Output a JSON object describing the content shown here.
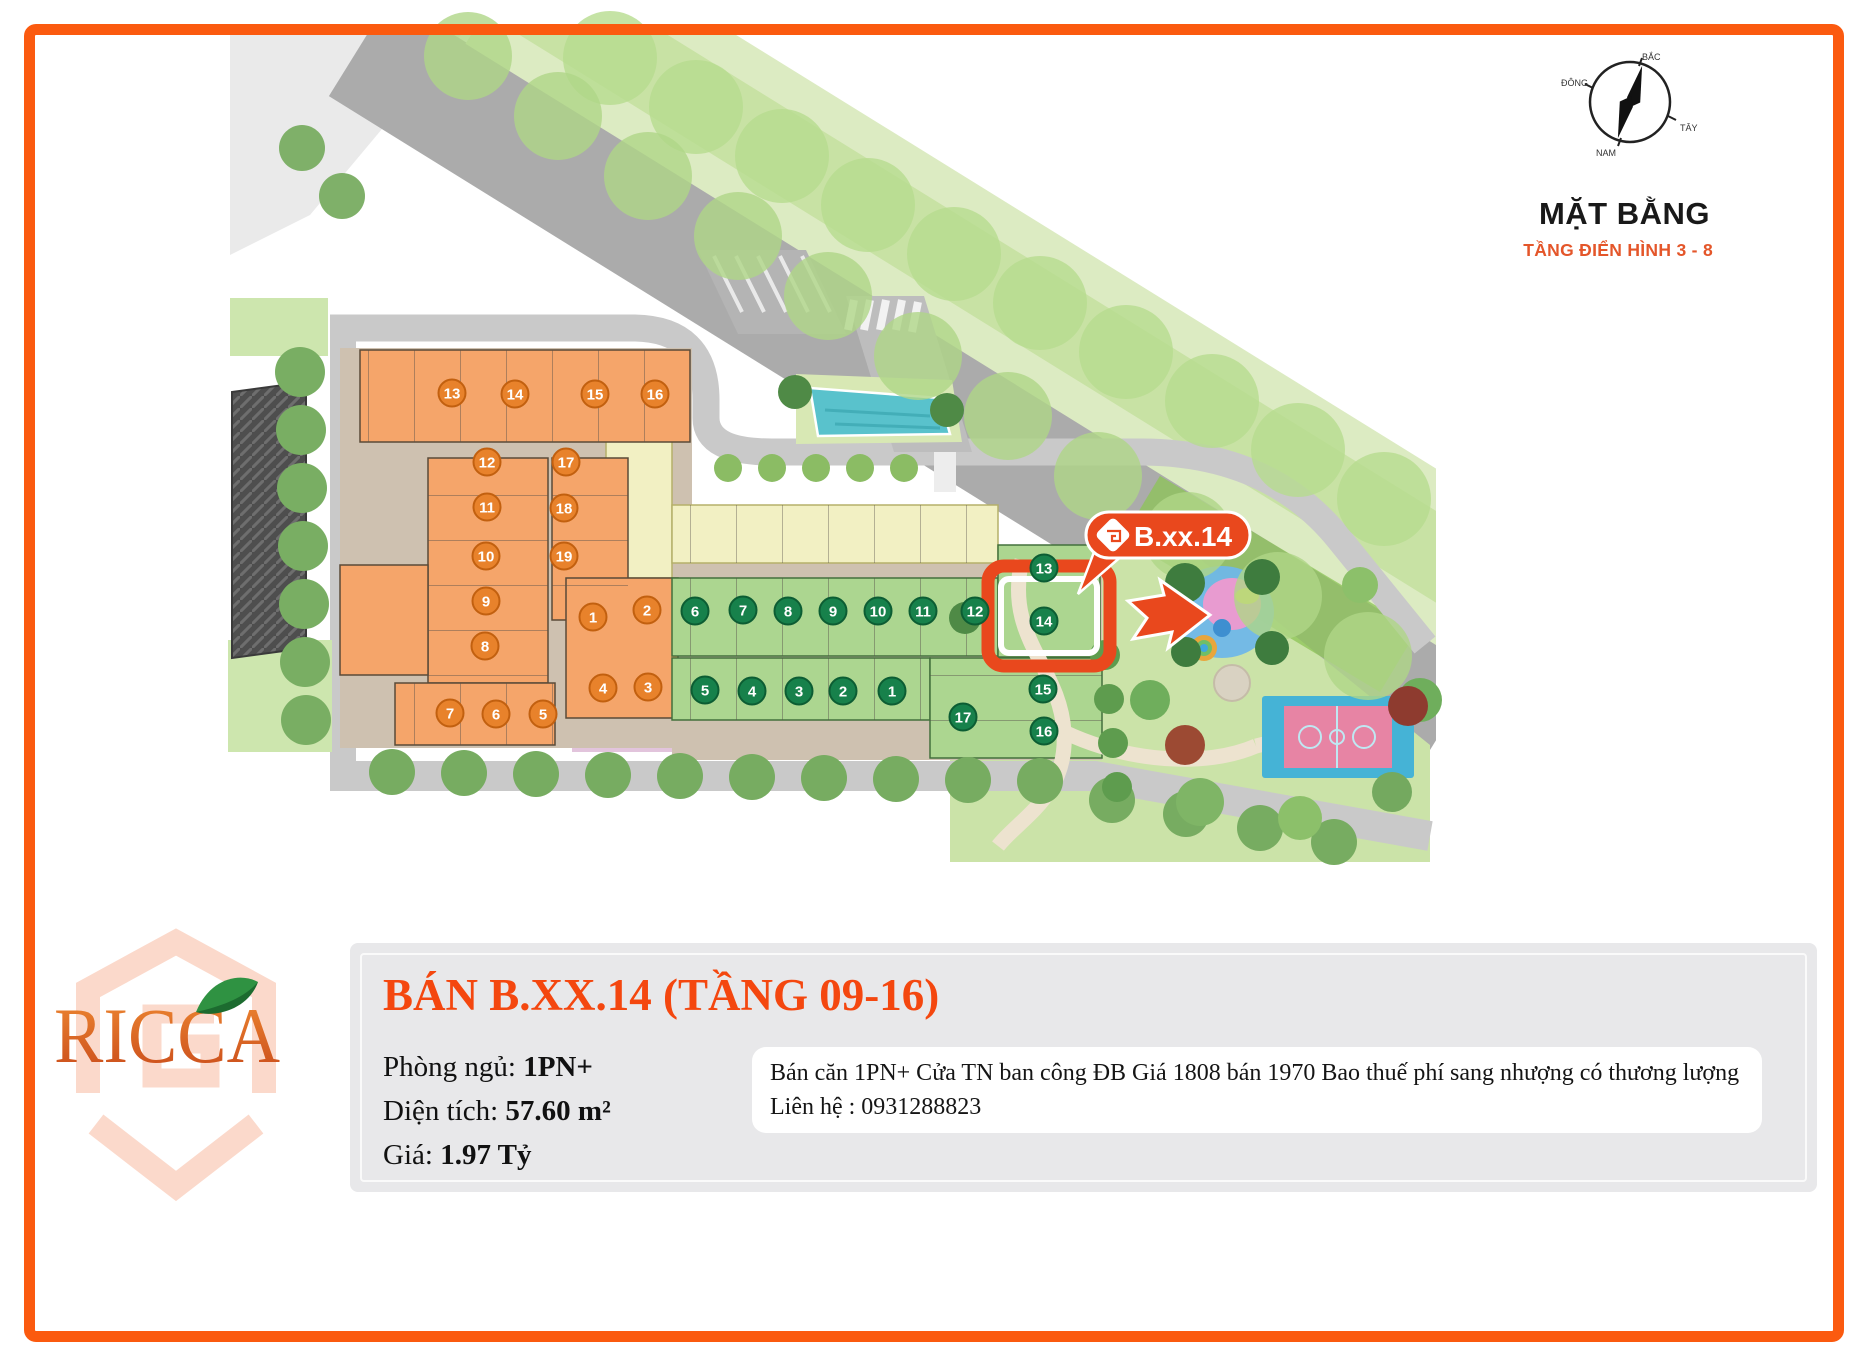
{
  "page": {
    "border_color": "#FB5A0F",
    "background": "#FFFFFF"
  },
  "plan": {
    "title": "MẶT BẰNG",
    "subtitle": "TẦNG ĐIỂN HÌNH 3 - 8",
    "compass": {
      "north": "BẮC",
      "south": "NAM",
      "east": "ĐÔNG",
      "west": "TÂY"
    },
    "marker_label": "B.xx.14",
    "highlighted_unit": "14",
    "colors": {
      "badge_orange": "#E8822B",
      "badge_orange_ring": "#C2600F",
      "badge_green": "#17814B",
      "badge_green_ring": "#0C5D33",
      "accent": "#E9481D"
    },
    "orange_units": [
      {
        "n": "13",
        "x": 452,
        "y": 393
      },
      {
        "n": "14",
        "x": 515,
        "y": 394
      },
      {
        "n": "15",
        "x": 595,
        "y": 394
      },
      {
        "n": "16",
        "x": 655,
        "y": 394
      },
      {
        "n": "12",
        "x": 487,
        "y": 462
      },
      {
        "n": "17",
        "x": 566,
        "y": 462
      },
      {
        "n": "11",
        "x": 487,
        "y": 507
      },
      {
        "n": "18",
        "x": 564,
        "y": 508
      },
      {
        "n": "10",
        "x": 486,
        "y": 556
      },
      {
        "n": "19",
        "x": 564,
        "y": 556
      },
      {
        "n": "9",
        "x": 486,
        "y": 601
      },
      {
        "n": "8",
        "x": 485,
        "y": 646
      },
      {
        "n": "1",
        "x": 593,
        "y": 617
      },
      {
        "n": "2",
        "x": 647,
        "y": 610
      },
      {
        "n": "4",
        "x": 603,
        "y": 688
      },
      {
        "n": "3",
        "x": 648,
        "y": 687
      },
      {
        "n": "5",
        "x": 543,
        "y": 714
      },
      {
        "n": "6",
        "x": 496,
        "y": 714
      },
      {
        "n": "7",
        "x": 450,
        "y": 713
      }
    ],
    "green_units": [
      {
        "n": "6",
        "x": 695,
        "y": 611
      },
      {
        "n": "7",
        "x": 743,
        "y": 610
      },
      {
        "n": "8",
        "x": 788,
        "y": 611
      },
      {
        "n": "9",
        "x": 833,
        "y": 611
      },
      {
        "n": "10",
        "x": 878,
        "y": 611
      },
      {
        "n": "11",
        "x": 923,
        "y": 611
      },
      {
        "n": "12",
        "x": 975,
        "y": 611
      },
      {
        "n": "13",
        "x": 1044,
        "y": 568
      },
      {
        "n": "14",
        "x": 1044,
        "y": 621
      },
      {
        "n": "5",
        "x": 705,
        "y": 690
      },
      {
        "n": "4",
        "x": 752,
        "y": 691
      },
      {
        "n": "3",
        "x": 799,
        "y": 691
      },
      {
        "n": "2",
        "x": 843,
        "y": 691
      },
      {
        "n": "1",
        "x": 892,
        "y": 691
      },
      {
        "n": "15",
        "x": 1043,
        "y": 689
      },
      {
        "n": "17",
        "x": 963,
        "y": 717
      },
      {
        "n": "16",
        "x": 1044,
        "y": 731
      }
    ],
    "tree_rows": [
      {
        "x": 610,
        "y": 58,
        "dx": 86,
        "dy": 49,
        "count": 10,
        "r": 47,
        "fill": "#B7DC8F",
        "opacity": 0.8
      },
      {
        "x": 468,
        "y": 56,
        "dx": 90,
        "dy": 60,
        "count": 11,
        "r": 44,
        "fill": "#AFD687",
        "opacity": 0.8
      },
      {
        "x": 392,
        "y": 772,
        "dx": 72,
        "dy": 1,
        "count": 10,
        "r": 23,
        "fill": "#77AC61",
        "opacity": 1
      },
      {
        "x": 1112,
        "y": 800,
        "dx": 74,
        "dy": 14,
        "count": 4,
        "r": 23,
        "fill": "#77AC61",
        "opacity": 1
      },
      {
        "x": 300,
        "y": 372,
        "dx": 1,
        "dy": 58,
        "count": 7,
        "r": 25,
        "fill": "#79AE63",
        "opacity": 1
      },
      {
        "x": 302,
        "y": 148,
        "dx": 40,
        "dy": 48,
        "count": 2,
        "r": 23,
        "fill": "#7FB069",
        "opacity": 1
      },
      {
        "x": 728,
        "y": 468,
        "dx": 44,
        "dy": 0,
        "count": 5,
        "r": 14,
        "fill": "#8BBC64",
        "opacity": 1
      },
      {
        "x": 795,
        "y": 392,
        "dx": 152,
        "dy": 18,
        "count": 2,
        "r": 17,
        "fill": "#4F8A46",
        "opacity": 1
      },
      {
        "x": 1105,
        "y": 655,
        "dx": 4,
        "dy": 44,
        "count": 4,
        "r": 15,
        "fill": "#5E9C4E",
        "opacity": 1
      }
    ],
    "park_trees": [
      {
        "x": 1150,
        "y": 700,
        "r": 20,
        "c": "#6FAE5C"
      },
      {
        "x": 1200,
        "y": 802,
        "r": 24,
        "c": "#7FB566"
      },
      {
        "x": 1300,
        "y": 818,
        "r": 22,
        "c": "#8CC06A"
      },
      {
        "x": 1392,
        "y": 792,
        "r": 20,
        "c": "#74A95F"
      },
      {
        "x": 1420,
        "y": 700,
        "r": 22,
        "c": "#6FAE5C"
      },
      {
        "x": 1185,
        "y": 583,
        "r": 20,
        "c": "#3E7C3E"
      },
      {
        "x": 1262,
        "y": 577,
        "r": 18,
        "c": "#3E7C3E"
      },
      {
        "x": 1186,
        "y": 652,
        "r": 15,
        "c": "#3E7C3E"
      },
      {
        "x": 1272,
        "y": 648,
        "r": 17,
        "c": "#3E7C3E"
      },
      {
        "x": 1185,
        "y": 745,
        "r": 20,
        "c": "#9C4A33"
      },
      {
        "x": 1408,
        "y": 706,
        "r": 20,
        "c": "#8E3B2F"
      },
      {
        "x": 1360,
        "y": 585,
        "r": 18,
        "c": "#8CC06A"
      },
      {
        "x": 965,
        "y": 618,
        "r": 16,
        "c": "#4F8A46"
      }
    ]
  },
  "listing": {
    "brand": "RICCA",
    "title": "BÁN B.XX.14 (TẦNG 09-16)",
    "specs": [
      {
        "label": "Phòng ngủ:",
        "value": "1PN+"
      },
      {
        "label": "Diện tích:",
        "value": "57.60 m²"
      },
      {
        "label": "Giá:",
        "value": "1.97 Tỷ"
      }
    ],
    "description": "Bán căn 1PN+ Cửa TN ban công ĐB Giá 1808 bán 1970 Bao thuế phí sang nhượng có thương lượng Liên hệ : 0931288823"
  }
}
